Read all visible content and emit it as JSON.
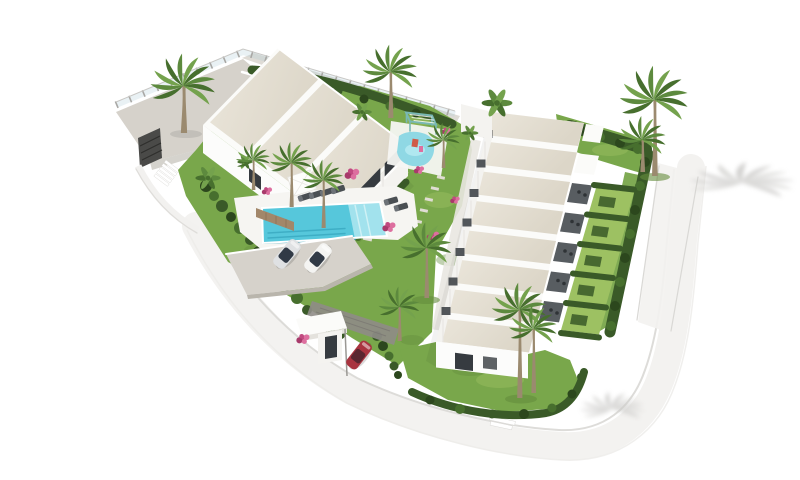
{
  "scene": {
    "description": "Aerial 3D architectural rendering, isolated on a white background, of a modern white residential complex: a three-unit townhouse block and an eight-unit townhouse row with light beige pitched roofs, a central landscaped garden with palm trees and pink bougainvillea, a turquoise swimming pool with sun loungers and a white parasol, a children's splash pool with a pergola, a parking area with a silver and a white car, a gated entrance canopy with a red car, clipped hedges and private yards, and a curving white perimeter road with palm-tree shadows.",
    "buildings": {
      "left_block": {
        "label": "three-unit townhouse block",
        "units": 3
      },
      "right_block": {
        "label": "eight-unit townhouse row",
        "units": 8
      }
    },
    "amenities": {
      "main_pool": "rectangular turquoise pool with steps",
      "kids_pool": "children's splash pool with pergola",
      "sun_loungers": 6,
      "parasols": 1,
      "parking_spaces": 2,
      "entrance": "white entrance canopy with gate"
    },
    "vehicles": [
      {
        "label": "silver car",
        "location": "parking"
      },
      {
        "label": "white car",
        "location": "parking"
      },
      {
        "label": "red car",
        "location": "entrance drive"
      }
    ],
    "vegetation": {
      "palm_trees": 12,
      "bougainvillea_clusters": 8,
      "hedges": "clipped boundary, yard and garden hedges",
      "lawns": "terraced lawns"
    }
  },
  "colors": {
    "bg": "#ffffff",
    "roof": "#ebe6db",
    "roof_shade": "#dcd6c8",
    "wall": "#f4f3f0",
    "wall_bright": "#fcfcfb",
    "wall_shade": "#e4e2dd",
    "parapet": "#fbfbf9",
    "window_dark": "#363b40",
    "grass": "#79a74b",
    "grass_light": "#9dc162",
    "grass_dark": "#648c3c",
    "hedge": "#3a5a28",
    "hedge_dark": "#2c471d",
    "frond": "#5d8a3e",
    "frond_dark": "#476f2e",
    "frond_light": "#74a24d",
    "trunk": "#9b8a6f",
    "pool": "#56c7db",
    "pool_light": "#a7e4ee",
    "pool_dark": "#2f9fb8",
    "kids_pool": "#8fd8e4",
    "deck": "#f6f5f2",
    "paving": "#d6d2cb",
    "paving_dark": "#b9b5ac",
    "road": "#f3f2f0",
    "road_line": "#d9d8d5",
    "ramp": "#8f8c87",
    "stone": "#a2876a",
    "flower": "#c14a80",
    "flower_light": "#dd6f9f",
    "flower_dark": "#a83a6b",
    "car_silver": "#dfe1e3",
    "car_white": "#f4f4f2",
    "car_red": "#a93440",
    "car_glass": "#313a46",
    "lounger": "#4a4f53",
    "parasol": "#fdfdfb",
    "pergola": "#79b8b4",
    "gate": "#4a4a48",
    "terrace_dark": "#585d61",
    "ac_dark": "#2f3336",
    "shadow": "#c9c8c6"
  }
}
